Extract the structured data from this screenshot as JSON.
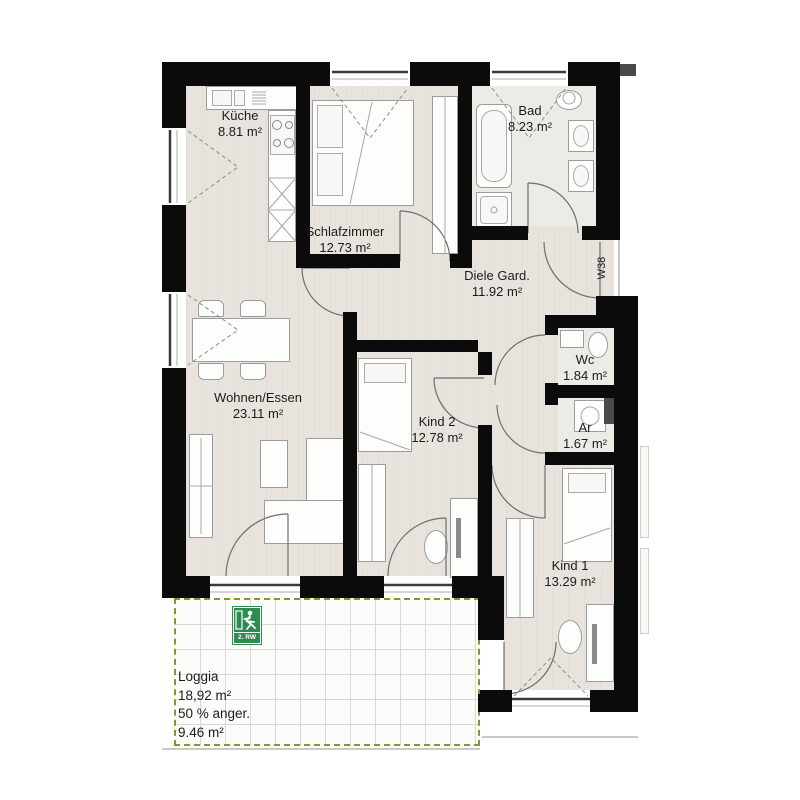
{
  "plan": {
    "unit_label": "W38",
    "exit_sign_label": "2. RW",
    "rooms": [
      {
        "id": "kueche",
        "name": "Küche",
        "area": "8.81 m²"
      },
      {
        "id": "schlafzimmer",
        "name": "Schlafzimmer",
        "area": "12.73 m²"
      },
      {
        "id": "bad",
        "name": "Bad",
        "area": "8.23 m²"
      },
      {
        "id": "diele",
        "name": "Diele Gard.",
        "area": "11.92 m²"
      },
      {
        "id": "wc",
        "name": "Wc",
        "area": "1.84 m²"
      },
      {
        "id": "ar",
        "name": "Ar",
        "area": "1.67 m²"
      },
      {
        "id": "wohnen",
        "name": "Wohnen/Essen",
        "area": "23.11 m²"
      },
      {
        "id": "kind2",
        "name": "Kind 2",
        "area": "12.78 m²"
      },
      {
        "id": "kind1",
        "name": "Kind 1",
        "area": "13.29 m²"
      }
    ],
    "loggia": {
      "name": "Loggia",
      "area": "18,92 m²",
      "note": "50 % anger.",
      "reduced_area": "9.46 m²"
    }
  },
  "colors": {
    "wall": "#0b0b0b",
    "floor": "#e8e4dd",
    "floor_light": "#edebe6",
    "loggia_grid": "#dadad4",
    "loggia_border": "#8f9130",
    "exit_green": "#2e8b50",
    "shaft_gray": "#4a4a4a"
  }
}
